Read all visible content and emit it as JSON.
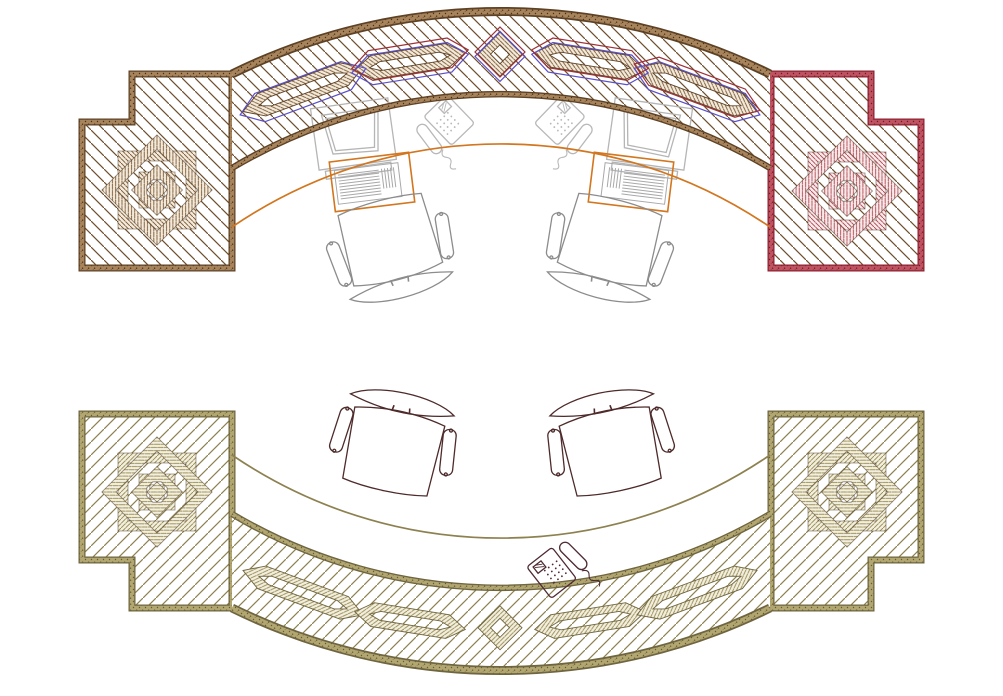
{
  "drawing": {
    "type": "floor-plan",
    "scene": "plan view of a curved reception counter suite: upper ornamented counter with two star end caps and guilloche band, mirrored lower counter, two computer workstations, three telephones, four task chairs",
    "colors": {
      "background": "#ffffff",
      "wood_brown": "#6f4e2c",
      "brown_dark": "#5d4226",
      "brown_sand": "#a8845c",
      "cap_red": "#a8323f",
      "red_dark": "#8e2230",
      "red_sand": "#bf5361",
      "olive": "#8d8150",
      "olive_dark": "#6f6540",
      "olive_sand": "#b2a771",
      "accent_red": "#9e3038",
      "accent_blue": "#5a4fc8",
      "counter_edge_orange": "#d2761f",
      "equipment_gray": "#b5b5b5",
      "keyboard_gray": "#a8a8a8",
      "chair_gray": "#8c8c8c",
      "chair_maroon": "#4e2a2a",
      "phone_maroon": "#4e2a32"
    },
    "objects": {
      "upper_counter_end_caps": 2,
      "lower_counter_end_caps": 2,
      "star_ornaments": 4,
      "monitors": 2,
      "keyboards": 2,
      "keyboard_trays": 2,
      "telephones_gray": 2,
      "telephones_maroon": 1,
      "chairs_upper": 2,
      "chairs_lower": 2
    }
  }
}
